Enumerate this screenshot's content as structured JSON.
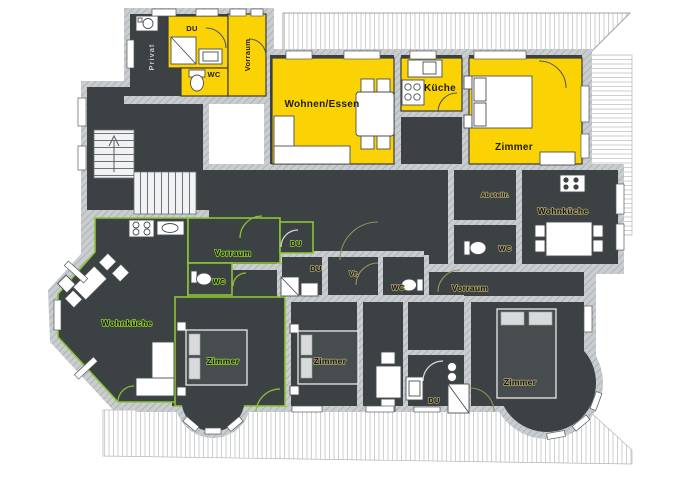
{
  "title": "Apartment floor plan",
  "labels": {
    "top_unit": {
      "du": "DU",
      "wc": "WC",
      "vorraum": "Vorraum",
      "privat": "Privat"
    },
    "main_unit": {
      "wohnen_essen": "Wohnen/Essen",
      "kueche": "Küche",
      "zimmer": "Zimmer"
    },
    "right_top_unit": {
      "abstellraum": "Abstellr.",
      "wc": "WC",
      "wohnkueche": "Wohnküche"
    },
    "green_unit": {
      "vorraum": "Vorraum",
      "wc": "WC",
      "du": "DU",
      "wohnkueche": "Wohnküche",
      "zimmer": "Zimmer"
    },
    "middle_unit": {
      "du": "DU",
      "vorraum_short": "Vr.",
      "wc": "WC",
      "zimmer": "Zimmer"
    },
    "right_unit": {
      "vorraum": "Vorraum",
      "zimmer": "Zimmer",
      "du": "DU"
    }
  },
  "colors": {
    "apartment_yellow": "#fbd304",
    "outline_green": "#8cc434",
    "floor_dark": "#3c4144",
    "wall_gray": "#c9cdd0",
    "background": "#ffffff"
  }
}
